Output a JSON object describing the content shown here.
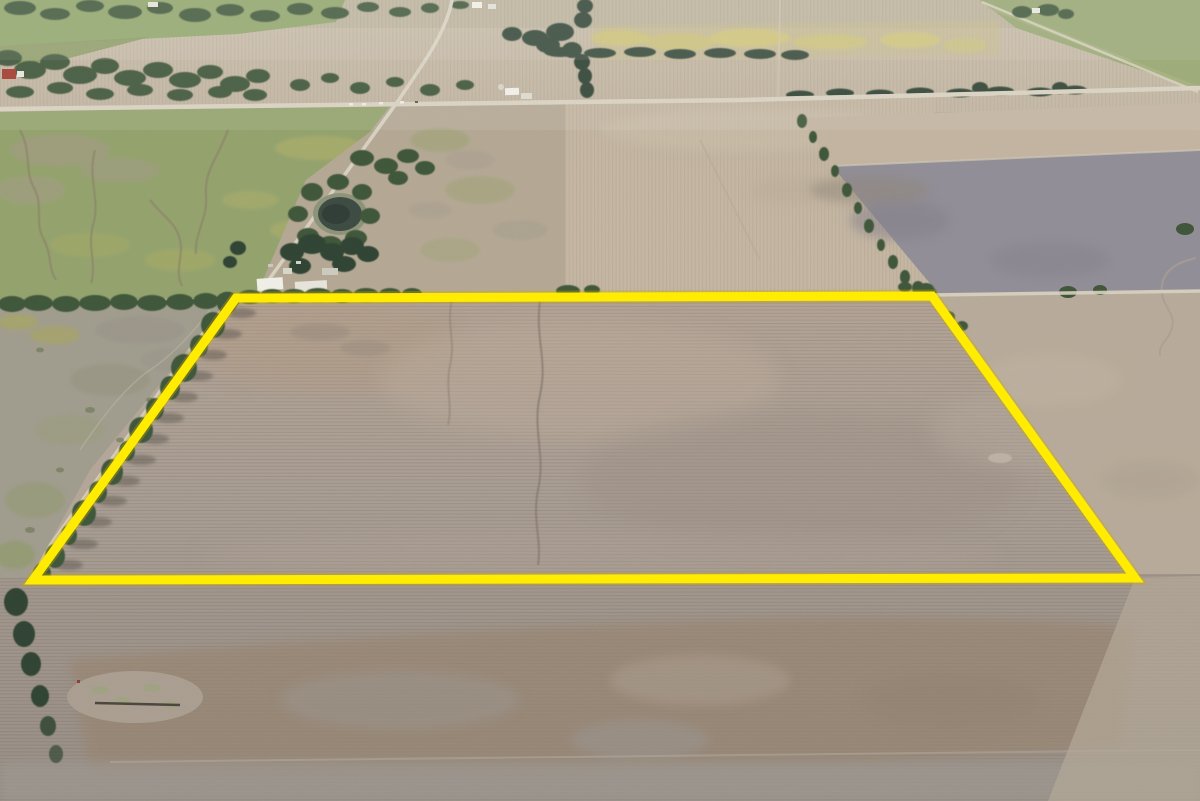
{
  "image": {
    "kind": "aerial-drone-photograph",
    "subject": "plowed farmland parcel outlined with a yellow property boundary",
    "width_px": 1200,
    "height_px": 801
  },
  "boundary": {
    "shape": "quadrilateral",
    "points": "236,298 932,296 1135,578 33,580",
    "stroke": "#ffec00",
    "stroke_width": 9,
    "glow": "#c9a900",
    "glow_width": 13
  },
  "palette": {
    "field_taupe": "#aa9e93",
    "field_taupe_light": "#b6a698",
    "field_buff": "#c4b6a1",
    "field_buff_light": "#d0c4b0",
    "pasture_green": "#93a26c",
    "pasture_yellow_green": "#b3b166",
    "flower_yellow": "#ccc172",
    "tree_green": "#3e5438",
    "tree_green_dark": "#2f4230",
    "dark_field": "#908d96",
    "brown_band": "#97836e",
    "wetland_gray": "#a09c8d",
    "road_light": "#d8d1c0",
    "pond_water": "#3b4a41",
    "building_white": "#f0efe8",
    "barn_red": "#a23b2e",
    "bottom_gray": "#9c968f"
  }
}
